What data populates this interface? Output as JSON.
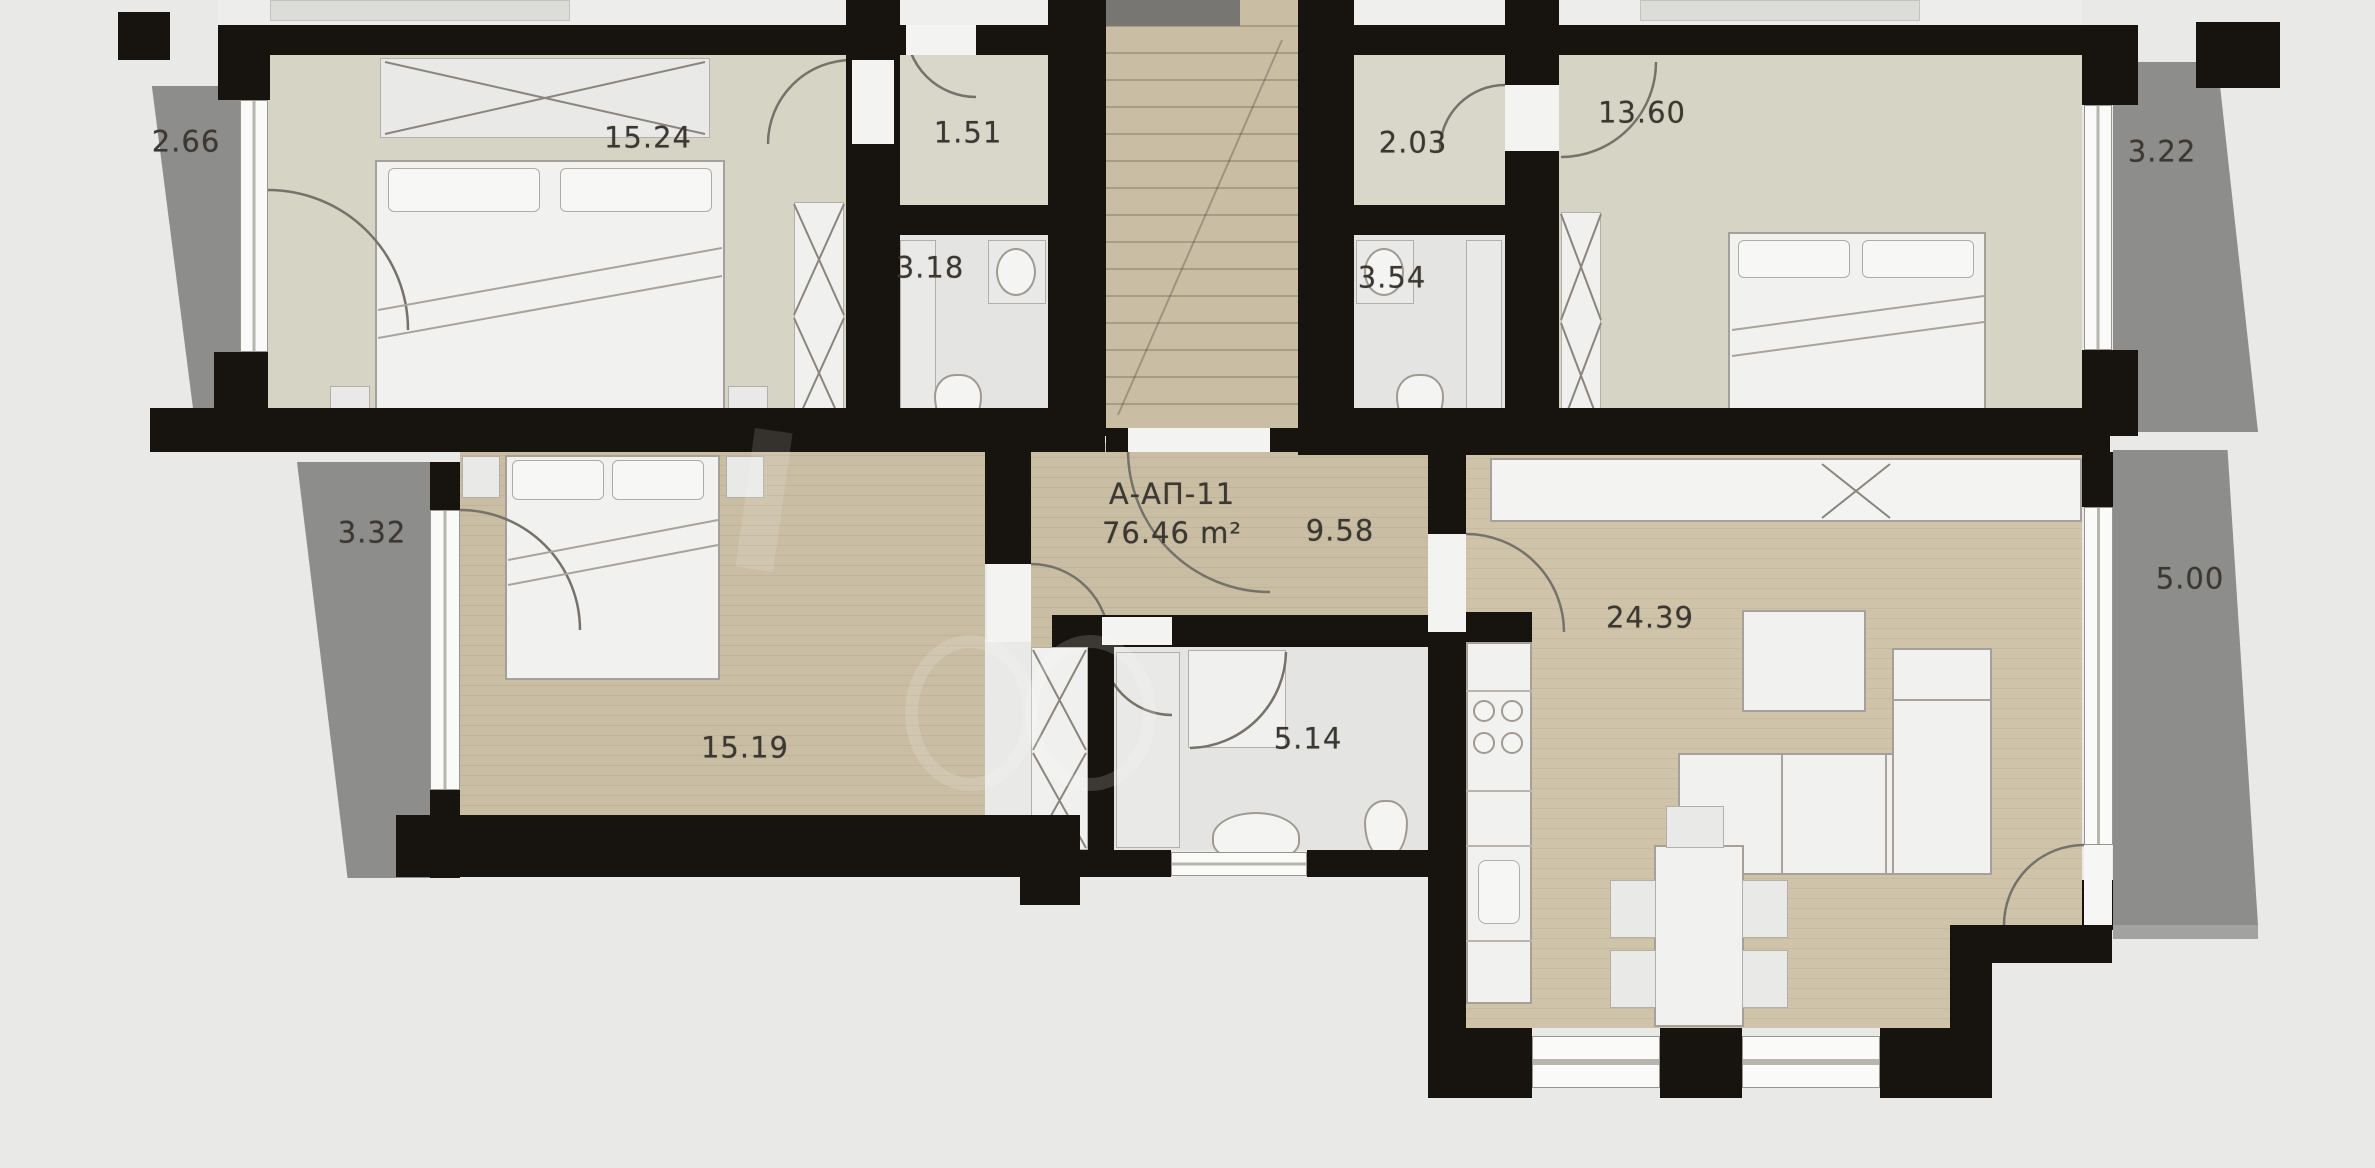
{
  "plan": {
    "apartment": {
      "code": "А-АП-11",
      "area": "76.46 m²"
    },
    "rooms": [
      {
        "name": "balcony-top-left",
        "area": "2.66"
      },
      {
        "name": "bedroom-top-left",
        "area": "15.24"
      },
      {
        "name": "entry-top-left",
        "area": "1.51"
      },
      {
        "name": "bath-top-left",
        "area": "3.18"
      },
      {
        "name": "entry-top-right",
        "area": "2.03"
      },
      {
        "name": "bath-top-right",
        "area": "3.54"
      },
      {
        "name": "bedroom-top-right",
        "area": "13.60"
      },
      {
        "name": "balcony-top-right",
        "area": "3.22"
      },
      {
        "name": "balcony-mid-left",
        "area": "3.32"
      },
      {
        "name": "bedroom-bottom",
        "area": "15.19"
      },
      {
        "name": "entry-hall",
        "area": "9.58"
      },
      {
        "name": "bathroom-bottom",
        "area": "5.14"
      },
      {
        "name": "living-room",
        "area": "24.39"
      },
      {
        "name": "balcony-right",
        "area": "5.00"
      }
    ],
    "colors": {
      "wall": "#17140f",
      "balcony": "#8d8d8b",
      "floor_tan": "#c9bda3",
      "floor_olive": "#d6d4c5",
      "floor_bath": "#e4e4e2",
      "background": "#e9e9e8"
    }
  }
}
